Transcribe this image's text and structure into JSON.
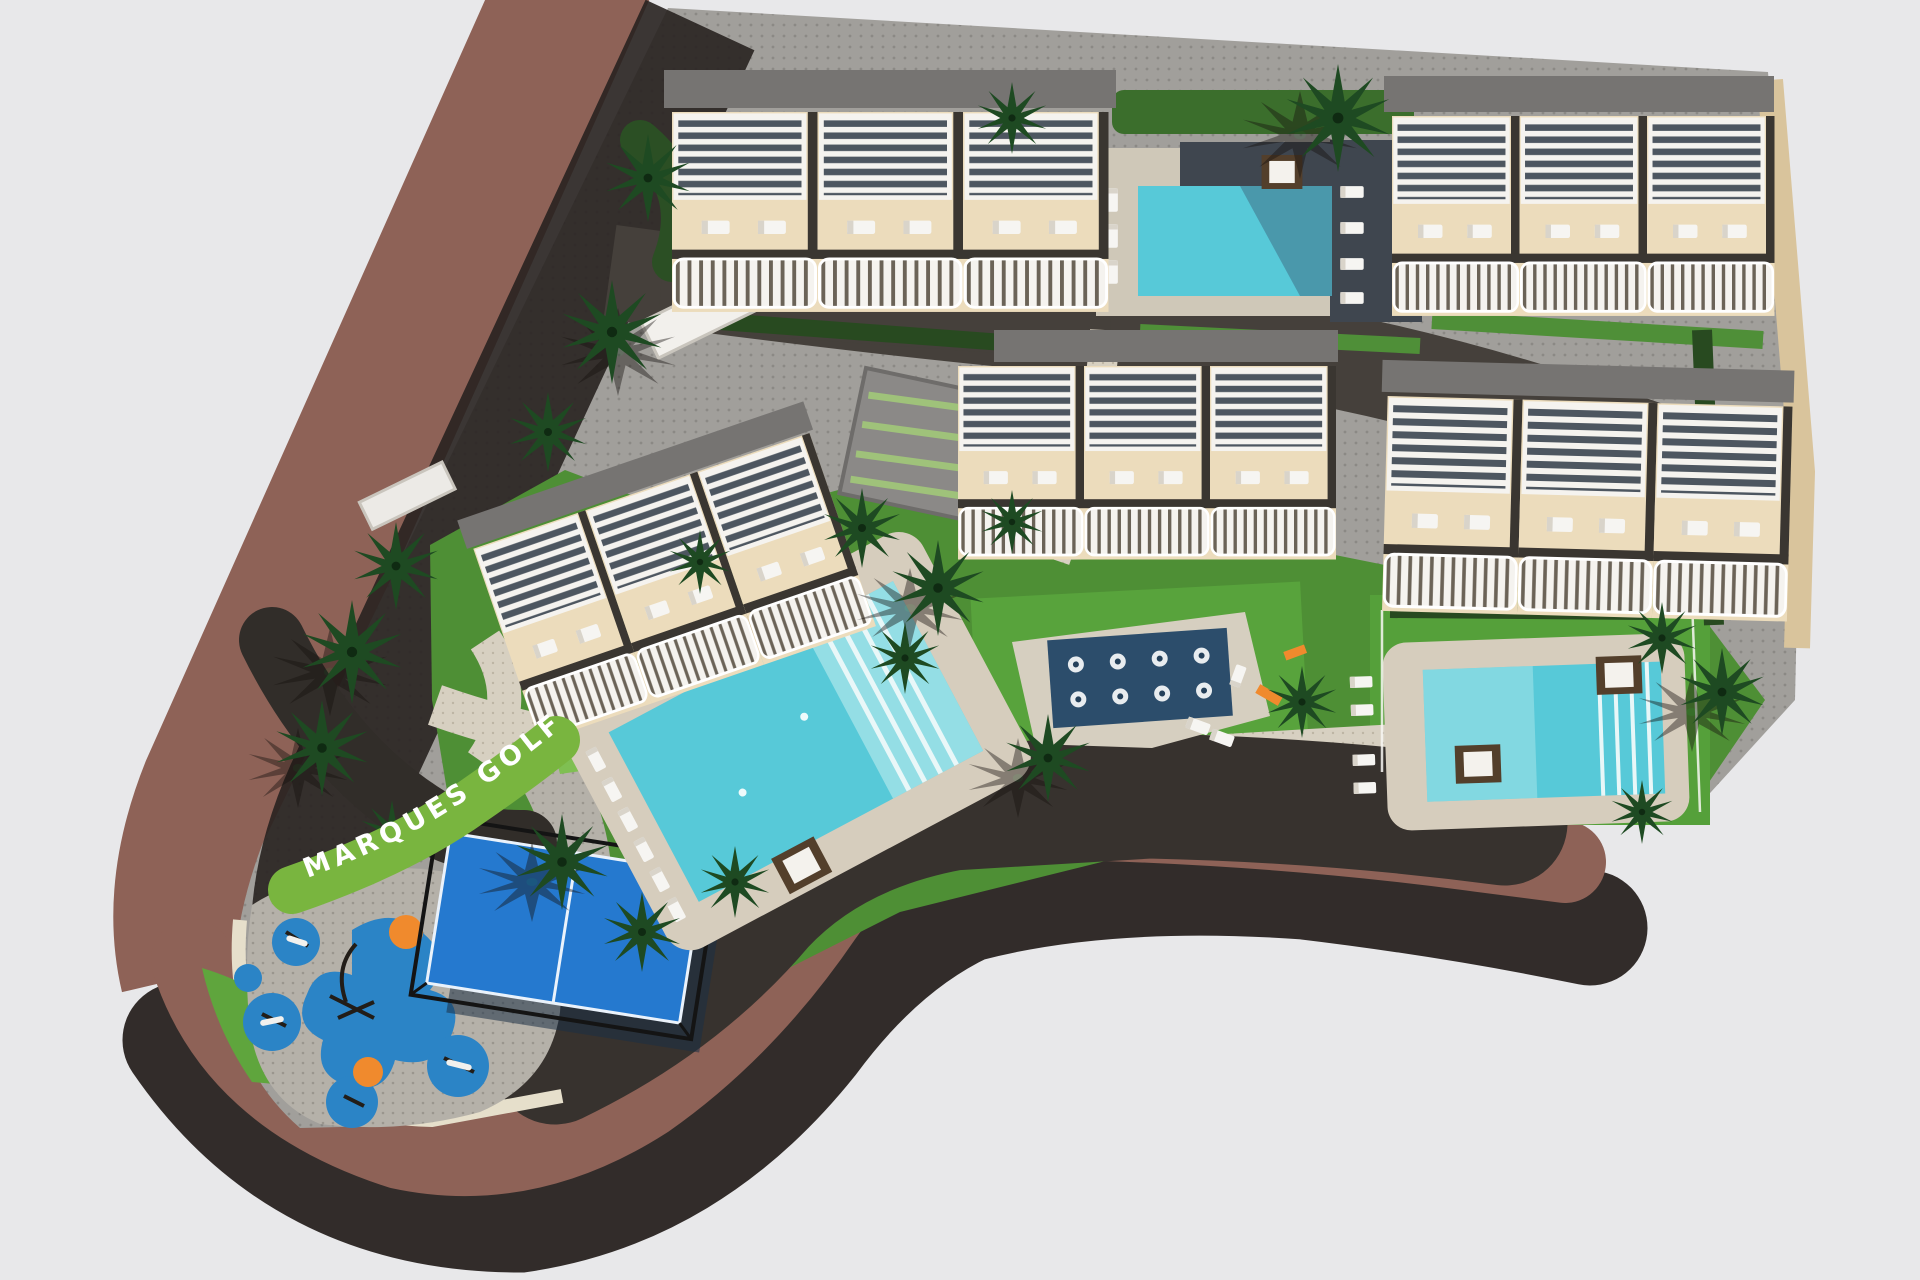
{
  "labels": {
    "road_text": "MARQUES GOLF"
  },
  "palette": {
    "background": "#e8e8ea",
    "road": "#8e6257",
    "shadow": "#282220",
    "asphalt": "#45403b",
    "dark_sweep": "#37322e",
    "paving": "#a19f9b",
    "paving_light": "#d7d0c1",
    "curb": "#e6dfcb",
    "lawn": "#4e8f35",
    "lawn_bright": "#58a33c",
    "hedge_dark": "#284a20",
    "hedge_bright": "#4f8f38",
    "building_wall": "#ecdcbc",
    "building_roof": "#767472",
    "pool_water": "#57c9d8",
    "pool_water_light": "#9fe2e8",
    "jet_pool": "#2c4d6b",
    "deck_dark": "#3f464f",
    "deck_beige": "#d6cdbd",
    "court_blue": "#2579cf",
    "playground_blue": "#2b84c6",
    "play_orange": "#f08a2d",
    "label_green": "#79b53f",
    "label_text": "#ffffff"
  },
  "scene": {
    "building_rows": 5,
    "swimming_pools": 3,
    "jet_water_features": 1,
    "padel_courts": 1,
    "playgrounds": 1
  }
}
